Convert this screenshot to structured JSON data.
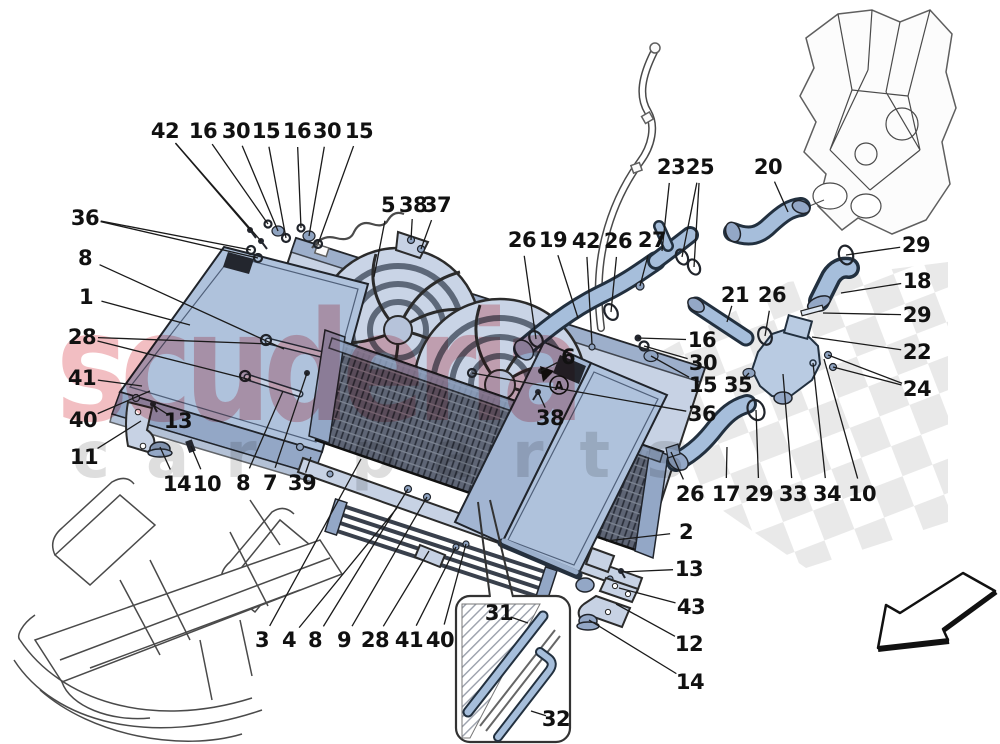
{
  "watermark": {
    "line1": "scuderia",
    "line2": "car parts"
  },
  "detail_marker": {
    "label": "A"
  },
  "colors": {
    "diagram_blue": "#afc2dc",
    "hose_blue": "#a6bedb",
    "outline_ink": "#1a1a1a",
    "checker_gray": "#e5e5e5",
    "condenser_dark": "#5e6575",
    "watermark_red": "#d9404a",
    "watermark_gray": "#8f8f8f"
  },
  "callouts": [
    {
      "label": "42",
      "x": 165,
      "y": 131,
      "targets": [
        [
          250,
          230
        ],
        [
          261,
          241
        ]
      ]
    },
    {
      "label": "16",
      "x": 203,
      "y": 131,
      "targets": [
        [
          268,
          224
        ]
      ]
    },
    {
      "label": "30",
      "x": 236,
      "y": 131,
      "targets": [
        [
          278,
          231
        ]
      ]
    },
    {
      "label": "15",
      "x": 266,
      "y": 131,
      "targets": [
        [
          286,
          238
        ]
      ]
    },
    {
      "label": "16",
      "x": 297,
      "y": 131,
      "targets": [
        [
          301,
          228
        ]
      ]
    },
    {
      "label": "30",
      "x": 327,
      "y": 131,
      "targets": [
        [
          309,
          236
        ]
      ]
    },
    {
      "label": "15",
      "x": 359,
      "y": 131,
      "targets": [
        [
          318,
          244
        ]
      ]
    },
    {
      "label": "36",
      "x": 85,
      "y": 218,
      "targets": [
        [
          251,
          250
        ],
        [
          258,
          258
        ]
      ]
    },
    {
      "label": "8",
      "x": 85,
      "y": 258,
      "targets": [
        [
          284,
          349
        ]
      ]
    },
    {
      "label": "1",
      "x": 86,
      "y": 297,
      "targets": [
        [
          190,
          325
        ]
      ]
    },
    {
      "label": "28",
      "x": 82,
      "y": 337,
      "targets": [
        [
          271,
          344
        ],
        [
          251,
          380
        ]
      ]
    },
    {
      "label": "41",
      "x": 82,
      "y": 378,
      "targets": [
        [
          142,
          386
        ]
      ]
    },
    {
      "label": "40",
      "x": 83,
      "y": 420,
      "targets": [
        [
          150,
          391
        ]
      ]
    },
    {
      "label": "11",
      "x": 84,
      "y": 457,
      "targets": [
        [
          141,
          421
        ]
      ]
    },
    {
      "label": "13",
      "x": 178,
      "y": 421,
      "targets": [
        [
          153,
          405
        ]
      ]
    },
    {
      "label": "14",
      "x": 177,
      "y": 484,
      "targets": [
        [
          160,
          447
        ]
      ]
    },
    {
      "label": "10",
      "x": 207,
      "y": 484,
      "targets": [
        [
          191,
          446
        ]
      ]
    },
    {
      "label": "8",
      "x": 243,
      "y": 483,
      "targets": [
        [
          283,
          391
        ]
      ]
    },
    {
      "label": "7",
      "x": 270,
      "y": 483,
      "targets": [
        [
          307,
          373
        ]
      ]
    },
    {
      "label": "39",
      "x": 302,
      "y": 483,
      "targets": [
        [
          311,
          457
        ]
      ]
    },
    {
      "label": "3",
      "x": 262,
      "y": 640,
      "targets": [
        [
          361,
          459
        ]
      ]
    },
    {
      "label": "4",
      "x": 289,
      "y": 640,
      "targets": [
        [
          397,
          508
        ]
      ]
    },
    {
      "label": "8",
      "x": 315,
      "y": 640,
      "targets": [
        [
          408,
          489
        ]
      ]
    },
    {
      "label": "9",
      "x": 344,
      "y": 640,
      "targets": [
        [
          427,
          497
        ]
      ]
    },
    {
      "label": "28",
      "x": 375,
      "y": 640,
      "targets": [
        [
          429,
          551
        ]
      ]
    },
    {
      "label": "41",
      "x": 409,
      "y": 640,
      "targets": [
        [
          456,
          547
        ]
      ]
    },
    {
      "label": "40",
      "x": 440,
      "y": 640,
      "targets": [
        [
          466,
          544
        ]
      ]
    },
    {
      "label": "31",
      "x": 499,
      "y": 613,
      "targets": [
        [
          528,
          623
        ]
      ]
    },
    {
      "label": "32",
      "x": 556,
      "y": 719,
      "targets": [
        [
          531,
          711
        ]
      ]
    },
    {
      "label": "2",
      "x": 686,
      "y": 532,
      "targets": [
        [
          606,
          541
        ]
      ]
    },
    {
      "label": "13",
      "x": 689,
      "y": 569,
      "targets": [
        [
          621,
          572
        ]
      ]
    },
    {
      "label": "43",
      "x": 691,
      "y": 607,
      "targets": [
        [
          619,
          588
        ]
      ]
    },
    {
      "label": "12",
      "x": 689,
      "y": 644,
      "targets": [
        [
          616,
          604
        ]
      ]
    },
    {
      "label": "14",
      "x": 690,
      "y": 682,
      "targets": [
        [
          589,
          620
        ]
      ]
    },
    {
      "label": "5",
      "x": 388,
      "y": 205,
      "targets": [
        [
          374,
          277
        ]
      ]
    },
    {
      "label": "38",
      "x": 413,
      "y": 205,
      "targets": [
        [
          411,
          240
        ]
      ]
    },
    {
      "label": "37",
      "x": 437,
      "y": 205,
      "targets": [
        [
          421,
          249
        ]
      ]
    },
    {
      "label": "26",
      "x": 522,
      "y": 240,
      "targets": [
        [
          536,
          339
        ]
      ]
    },
    {
      "label": "19",
      "x": 553,
      "y": 240,
      "targets": [
        [
          578,
          318
        ]
      ]
    },
    {
      "label": "42",
      "x": 586,
      "y": 241,
      "targets": [
        [
          592,
          344
        ]
      ]
    },
    {
      "label": "26",
      "x": 618,
      "y": 241,
      "targets": [
        [
          611,
          312
        ]
      ]
    },
    {
      "label": "27",
      "x": 652,
      "y": 240,
      "targets": [
        [
          640,
          286
        ]
      ]
    },
    {
      "label": "23",
      "x": 671,
      "y": 167,
      "targets": [
        [
          662,
          251
        ]
      ]
    },
    {
      "label": "25",
      "x": 700,
      "y": 167,
      "targets": [
        [
          682,
          257
        ],
        [
          694,
          267
        ]
      ]
    },
    {
      "label": "20",
      "x": 768,
      "y": 167,
      "targets": [
        [
          788,
          212
        ]
      ]
    },
    {
      "label": "29",
      "x": 916,
      "y": 245,
      "targets": [
        [
          846,
          255
        ]
      ]
    },
    {
      "label": "18",
      "x": 917,
      "y": 281,
      "targets": [
        [
          841,
          293
        ]
      ]
    },
    {
      "label": "29",
      "x": 917,
      "y": 315,
      "targets": [
        [
          823,
          313
        ]
      ]
    },
    {
      "label": "22",
      "x": 917,
      "y": 352,
      "targets": [
        [
          812,
          337
        ]
      ]
    },
    {
      "label": "24",
      "x": 917,
      "y": 389,
      "targets": [
        [
          828,
          355
        ],
        [
          833,
          367
        ]
      ]
    },
    {
      "label": "21",
      "x": 735,
      "y": 295,
      "targets": [
        [
          727,
          322
        ]
      ]
    },
    {
      "label": "26",
      "x": 772,
      "y": 295,
      "targets": [
        [
          765,
          336
        ]
      ]
    },
    {
      "label": "16",
      "x": 702,
      "y": 340,
      "targets": [
        [
          638,
          338
        ]
      ]
    },
    {
      "label": "30",
      "x": 703,
      "y": 363,
      "targets": [
        [
          644,
          346
        ]
      ]
    },
    {
      "label": "15",
      "x": 703,
      "y": 385,
      "targets": [
        [
          651,
          356
        ]
      ]
    },
    {
      "label": "36",
      "x": 702,
      "y": 414,
      "targets": [
        [
          472,
          373
        ]
      ]
    },
    {
      "label": "35",
      "x": 738,
      "y": 385,
      "targets": [
        [
          749,
          373
        ]
      ]
    },
    {
      "label": "38",
      "x": 550,
      "y": 418,
      "targets": [
        [
          538,
          392
        ]
      ]
    },
    {
      "label": "6",
      "x": 568,
      "y": 357,
      "targets": [
        [
          541,
          371
        ]
      ]
    },
    {
      "label": "26",
      "x": 690,
      "y": 494,
      "targets": [
        [
          671,
          452
        ]
      ]
    },
    {
      "label": "17",
      "x": 726,
      "y": 494,
      "targets": [
        [
          727,
          447
        ]
      ]
    },
    {
      "label": "29",
      "x": 759,
      "y": 494,
      "targets": [
        [
          756,
          410
        ]
      ]
    },
    {
      "label": "33",
      "x": 793,
      "y": 494,
      "targets": [
        [
          783,
          374
        ]
      ]
    },
    {
      "label": "34",
      "x": 827,
      "y": 494,
      "targets": [
        [
          813,
          363
        ]
      ]
    },
    {
      "label": "10",
      "x": 862,
      "y": 494,
      "targets": [
        [
          824,
          359
        ]
      ]
    }
  ]
}
